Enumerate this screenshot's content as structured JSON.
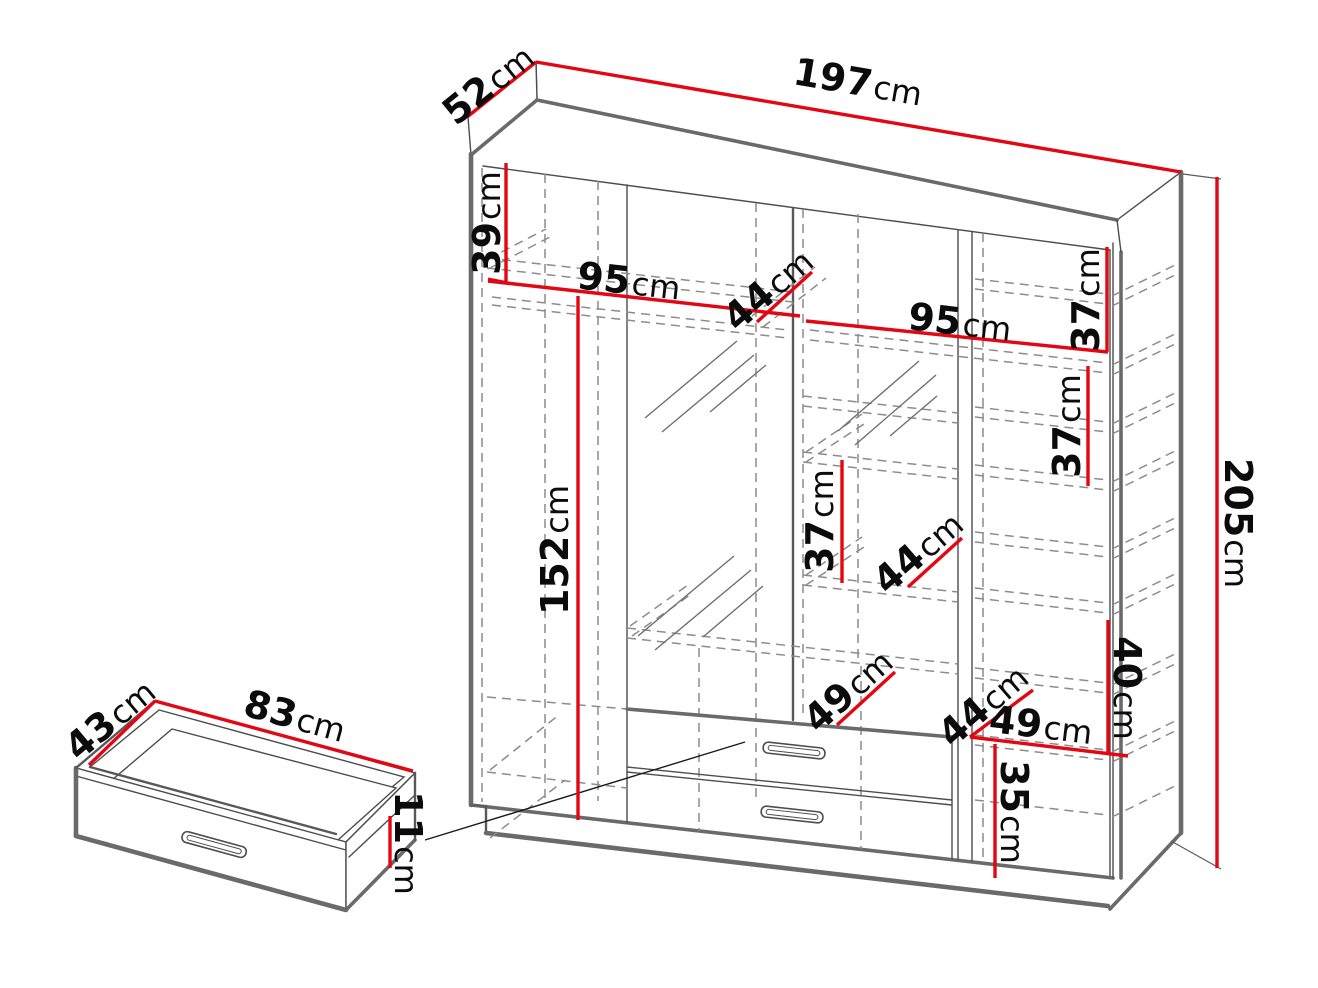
{
  "diagram": {
    "type": "furniture-dimension-drawing",
    "subject": "wardrobe-with-drawer-detail",
    "unit": "cm",
    "colors": {
      "dimension_line": "#e30613",
      "outline": "#4d4d4d",
      "hidden_line": "#8c8c8c",
      "label_text": "#0b0b0b",
      "background": "#ffffff"
    },
    "dims": {
      "d197": {
        "num": "197",
        "unit": "cm"
      },
      "d52": {
        "num": "52",
        "unit": "cm"
      },
      "d205": {
        "num": "205",
        "unit": "cm"
      },
      "d39": {
        "num": "39",
        "unit": "cm"
      },
      "d95l": {
        "num": "95",
        "unit": "cm"
      },
      "d44a": {
        "num": "44",
        "unit": "cm"
      },
      "d95r": {
        "num": "95",
        "unit": "cm"
      },
      "d37a": {
        "num": "37",
        "unit": "cm"
      },
      "d37b": {
        "num": "37",
        "unit": "cm"
      },
      "d37c": {
        "num": "37",
        "unit": "cm"
      },
      "d44b": {
        "num": "44",
        "unit": "cm"
      },
      "d152": {
        "num": "152",
        "unit": "cm"
      },
      "d49a": {
        "num": "49",
        "unit": "cm"
      },
      "d44c": {
        "num": "44",
        "unit": "cm"
      },
      "d49b": {
        "num": "49",
        "unit": "cm"
      },
      "d40": {
        "num": "40",
        "unit": "cm"
      },
      "d35": {
        "num": "35",
        "unit": "cm"
      },
      "d43": {
        "num": "43",
        "unit": "cm"
      },
      "d83": {
        "num": "83",
        "unit": "cm"
      },
      "d11": {
        "num": "11",
        "unit": "cm"
      }
    }
  }
}
